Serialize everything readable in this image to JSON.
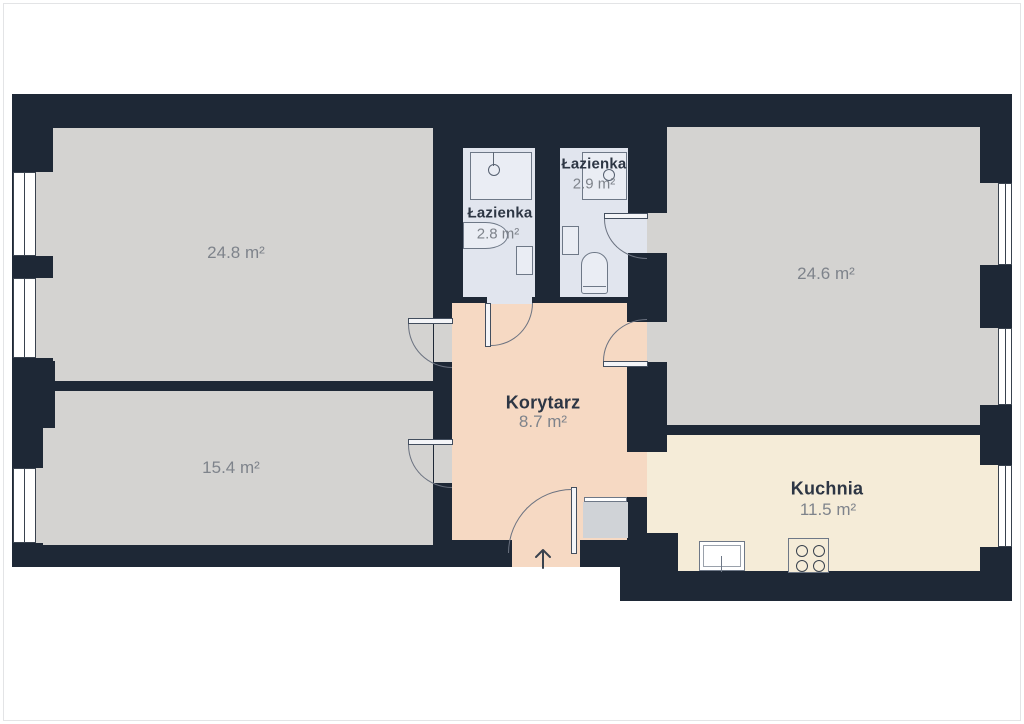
{
  "title": "Rzut mieszkania (floor plan)",
  "colors": {
    "wall": "#1e2836",
    "room_floor": "#d4d3d1",
    "corridor_floor": "#f6d9c3",
    "kitchen_floor": "#f5ecd8",
    "bathroom_floor": "#e1e5ee",
    "landing_floor": "#d0d3d7",
    "label_dark": "#2d3644",
    "label_gray": "#7e838b"
  },
  "rooms": {
    "room1": {
      "area": "24.8 m²"
    },
    "room2": {
      "area": "15.4 m²"
    },
    "room3": {
      "area": "24.6 m²"
    },
    "kitchen": {
      "name": "Kuchnia",
      "area": "11.5 m²"
    },
    "corridor": {
      "name": "Korytarz",
      "area": "8.7 m²"
    },
    "bath1": {
      "name": "Łazienka",
      "area": "2.8 m²"
    },
    "bath2": {
      "name": "Łazienka",
      "area": "2.9 m²"
    }
  },
  "icons": {
    "entrance_arrow_icon": "↑",
    "fixtures": [
      "shower",
      "sink",
      "toilet",
      "radiator",
      "kitchen-sink",
      "stove-hob",
      "window",
      "door-swing"
    ]
  }
}
